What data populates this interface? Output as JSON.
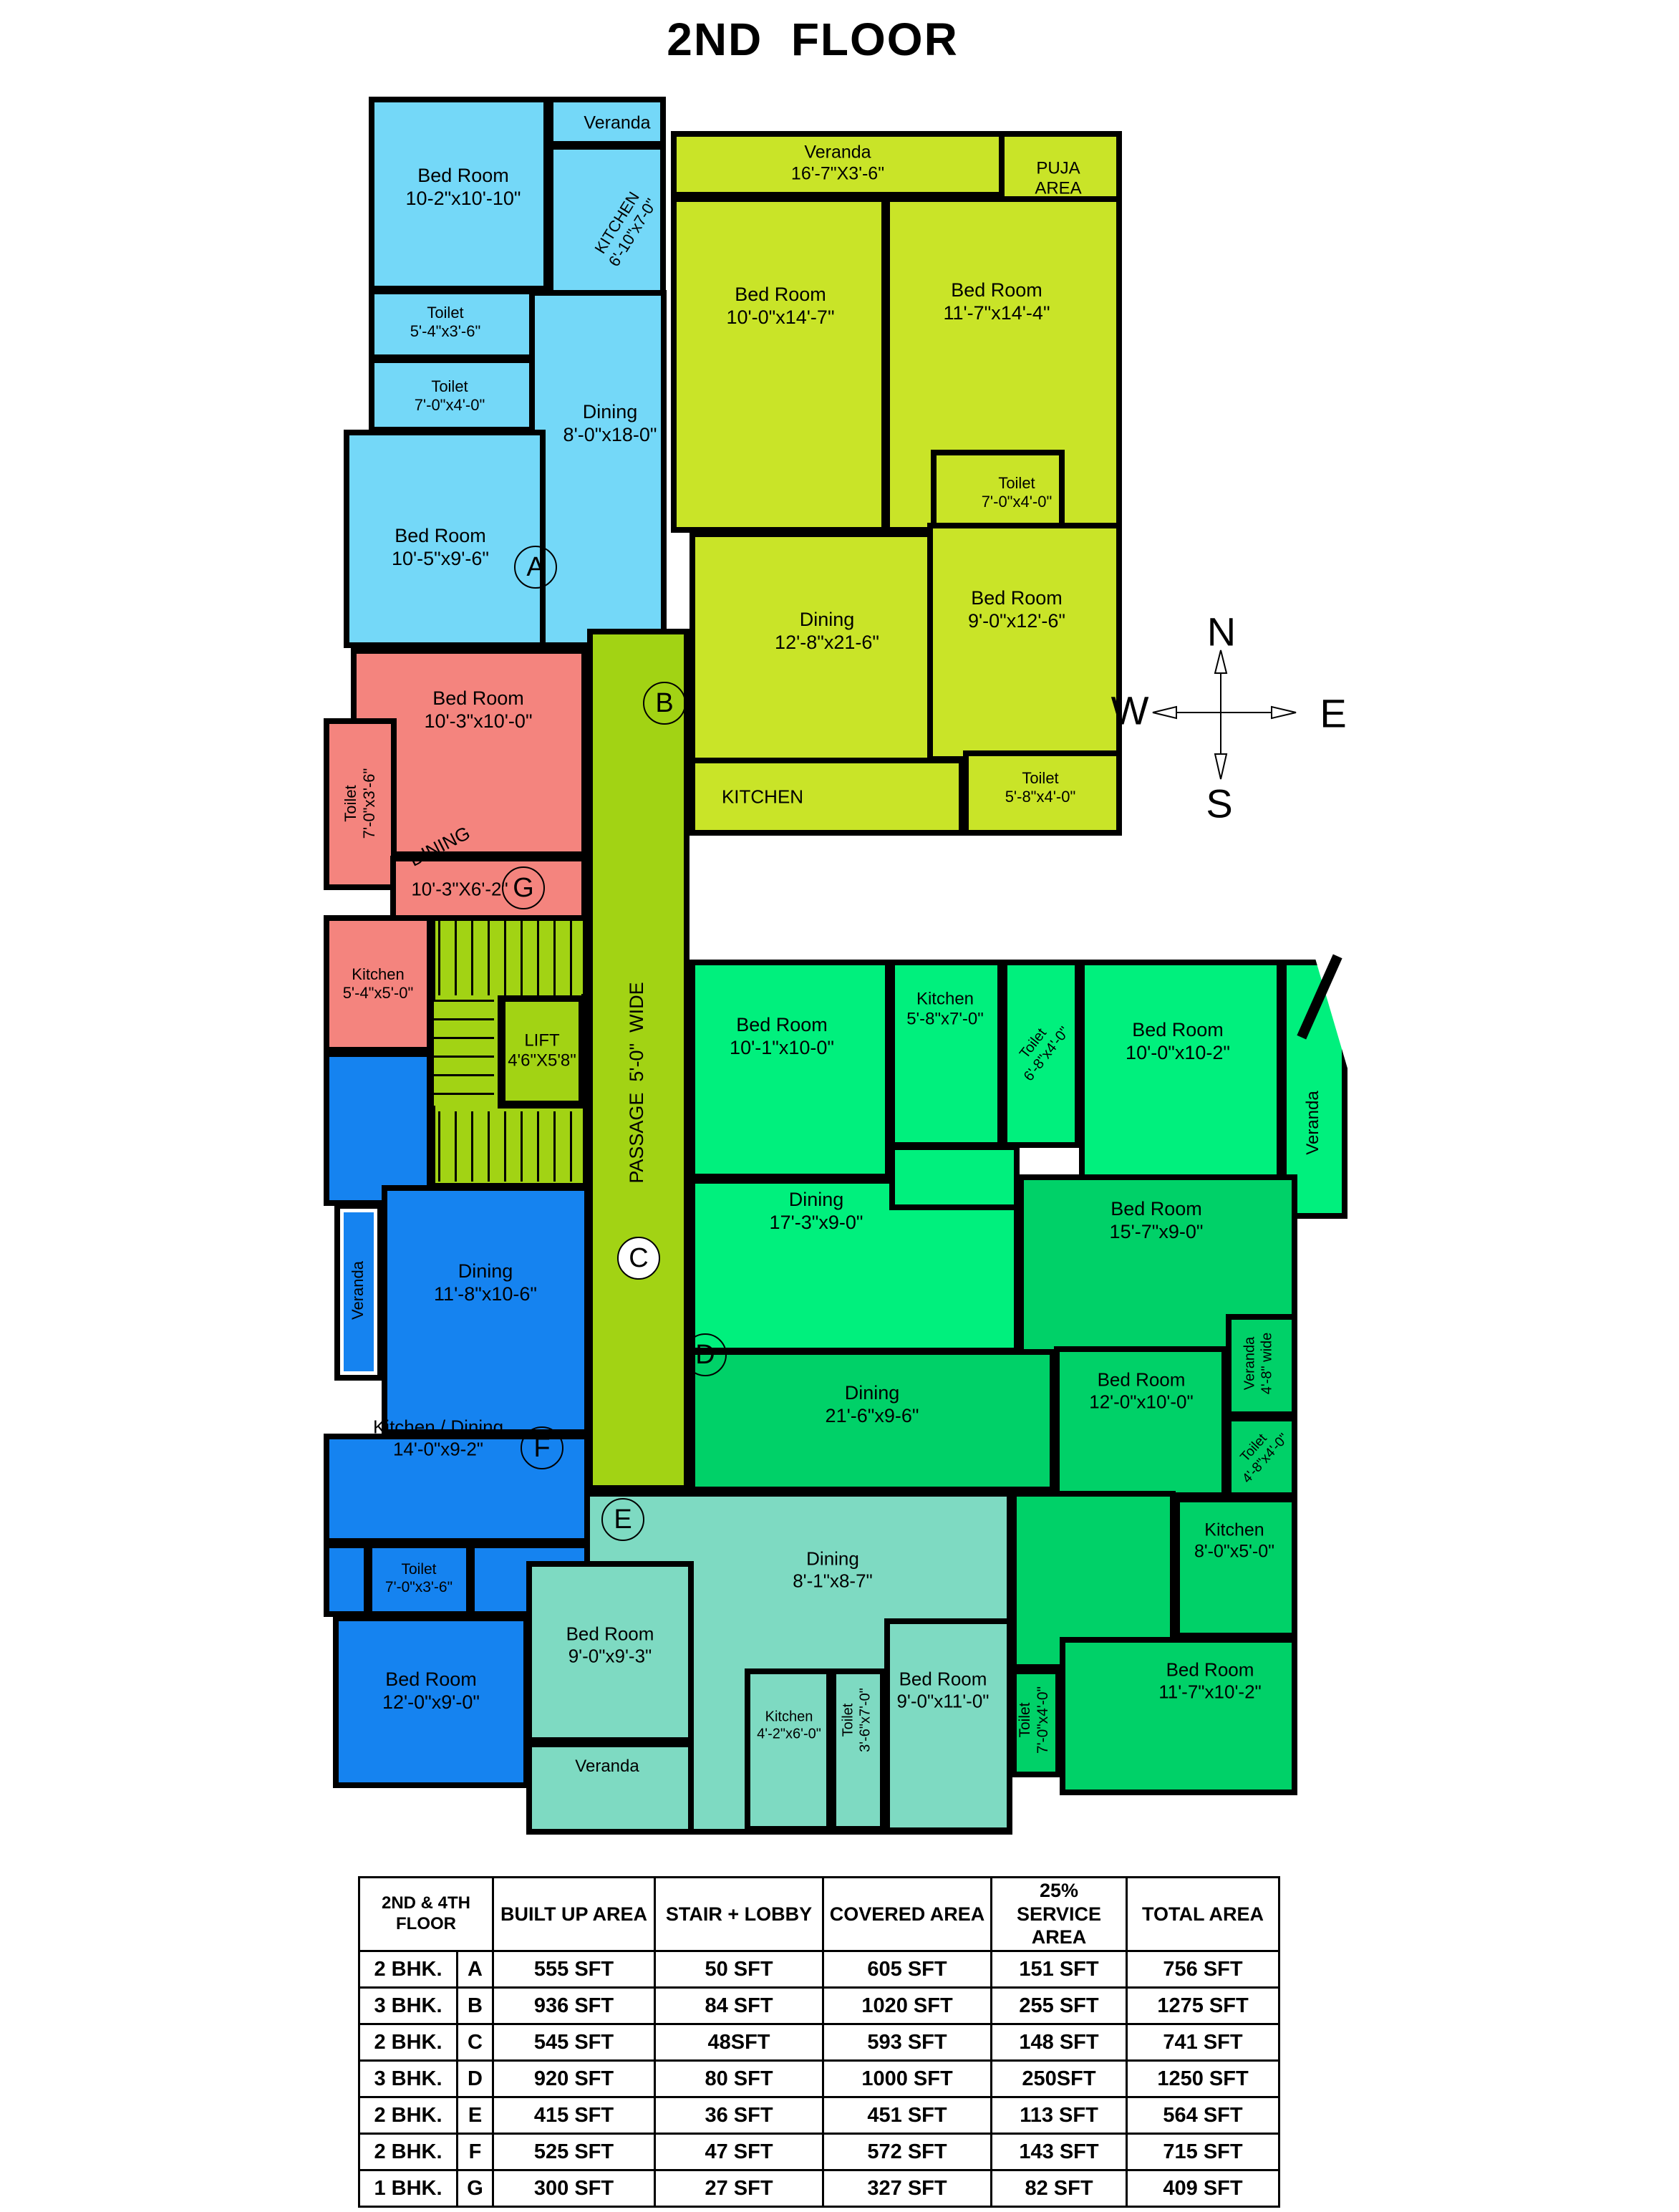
{
  "title": "2ND  FLOOR",
  "compass": {
    "north": "N",
    "south": "S",
    "east": "E",
    "west": "W"
  },
  "colors": {
    "unit_a": "#74D8F8",
    "unit_b": "#C9E428",
    "unit_c": "#00F07D",
    "unit_d": "#00D168",
    "unit_e": "#7EDAC2",
    "unit_f": "#1583F0",
    "unit_g": "#F4847E",
    "passage": "#A2D314",
    "wall": "#000000"
  },
  "plan": {
    "labels": [
      {
        "id": "a-bed1",
        "lines": [
          "Bed Room",
          "10-2\"x10'-10\""
        ]
      },
      {
        "id": "a-veranda",
        "lines": [
          "Veranda"
        ]
      },
      {
        "id": "a-kitchen",
        "lines": [
          "KITCHEN",
          "6'-10\"x7-0\""
        ]
      },
      {
        "id": "a-toilet1",
        "lines": [
          "Toilet",
          "5'-4\"x3'-6\""
        ]
      },
      {
        "id": "a-toilet2",
        "lines": [
          "Toilet",
          "7'-0\"x4'-0\""
        ]
      },
      {
        "id": "a-dining",
        "lines": [
          "Dining",
          "8'-0\"x18-0\""
        ]
      },
      {
        "id": "a-bed2",
        "lines": [
          "Bed Room",
          "10'-5\"x9'-6\""
        ]
      },
      {
        "id": "b-veranda",
        "lines": [
          "Veranda",
          "16'-7\"X3'-6\""
        ]
      },
      {
        "id": "b-puja",
        "lines": [
          "PUJA",
          "AREA"
        ]
      },
      {
        "id": "b-bed1",
        "lines": [
          "Bed Room",
          "10'-0\"x14'-7\""
        ]
      },
      {
        "id": "b-bed2",
        "lines": [
          "Bed Room",
          "11'-7\"x14'-4\""
        ]
      },
      {
        "id": "b-toilet1",
        "lines": [
          "Toilet",
          "7'-0\"x4'-0\""
        ]
      },
      {
        "id": "b-dining",
        "lines": [
          "Dining",
          "12'-8\"x21-6\""
        ]
      },
      {
        "id": "b-bed3",
        "lines": [
          "Bed Room",
          "9'-0\"x12'-6\""
        ]
      },
      {
        "id": "b-kitchen",
        "lines": [
          "KITCHEN"
        ]
      },
      {
        "id": "b-toilet2",
        "lines": [
          "Toilet",
          "5'-8\"x4'-0\""
        ]
      },
      {
        "id": "g-bed",
        "lines": [
          "Bed Room",
          "10'-3\"x10'-0\""
        ]
      },
      {
        "id": "g-toilet",
        "lines": [
          "Toilet",
          "7'-0\"x3'-6\""
        ]
      },
      {
        "id": "g-dining-word",
        "lines": [
          "DINING"
        ]
      },
      {
        "id": "g-dining-dims",
        "lines": [
          "10'-3\"X6'-2\""
        ]
      },
      {
        "id": "g-kitchen",
        "lines": [
          "Kitchen",
          "5'-4\"x5'-0\""
        ]
      },
      {
        "id": "passage",
        "lines": [
          "PASSAGE  5'-0\"  WIDE"
        ]
      },
      {
        "id": "lift",
        "lines": [
          "LIFT",
          "4'6\"X5'8\""
        ]
      },
      {
        "id": "c-bed1",
        "lines": [
          "Bed Room",
          "10'-1\"x10-0\""
        ]
      },
      {
        "id": "c-kitchen",
        "lines": [
          "Kitchen",
          "5'-8\"x7'-0\""
        ]
      },
      {
        "id": "c-toilet",
        "lines": [
          "Toilet",
          "6'-8\"x4'-0\""
        ]
      },
      {
        "id": "c-bed2",
        "lines": [
          "Bed Room",
          "10'-0\"x10-2\""
        ]
      },
      {
        "id": "c-veranda",
        "lines": [
          "Veranda"
        ]
      },
      {
        "id": "c-dining",
        "lines": [
          "Dining",
          "17'-3\"x9-0\""
        ]
      },
      {
        "id": "f-veranda",
        "lines": [
          "Veranda"
        ]
      },
      {
        "id": "f-dining",
        "lines": [
          "Dining",
          "11'-8\"x10-6\""
        ]
      },
      {
        "id": "f-kitchen",
        "lines": [
          "Kitchen / Dining",
          "14'-0\"x9-2\""
        ]
      },
      {
        "id": "f-toilet1",
        "lines": [
          "Toilet",
          "7'-0\"x3'-6\""
        ]
      },
      {
        "id": "f-bed",
        "lines": [
          "Bed Room",
          "12'-0\"x9'-0\""
        ]
      },
      {
        "id": "d-bed1",
        "lines": [
          "Bed Room",
          "15'-7\"x9-0\""
        ]
      },
      {
        "id": "d-dining",
        "lines": [
          "Dining",
          "21'-6\"x9-6\""
        ]
      },
      {
        "id": "d-bed2",
        "lines": [
          "Bed Room",
          "12'-0\"x10'-0\""
        ]
      },
      {
        "id": "d-veranda",
        "lines": [
          "Veranda",
          "4'-8\" wide"
        ]
      },
      {
        "id": "d-toilet1",
        "lines": [
          "Toilet",
          "4'-8\"x4'-0\""
        ]
      },
      {
        "id": "d-kitchen",
        "lines": [
          "Kitchen",
          "8'-0\"x5'-0\""
        ]
      },
      {
        "id": "d-bed3",
        "lines": [
          "Bed Room",
          "11'-7\"x10'-2\""
        ]
      },
      {
        "id": "d-toilet2",
        "lines": [
          "Toilet",
          "7'-0\"x4'-0\""
        ]
      },
      {
        "id": "e-dining",
        "lines": [
          "Dining",
          "8'-1\"x8-7\""
        ]
      },
      {
        "id": "e-bed1",
        "lines": [
          "Bed Room",
          "9'-0\"x9'-3\""
        ]
      },
      {
        "id": "e-veranda",
        "lines": [
          "Veranda"
        ]
      },
      {
        "id": "e-kitchen",
        "lines": [
          "Kitchen",
          "4'-2\"x6'-0\""
        ]
      },
      {
        "id": "e-toilet",
        "lines": [
          "Toilet",
          "3'-6\"x7'-0\""
        ]
      },
      {
        "id": "e-bed2",
        "lines": [
          "Bed Room",
          "9'-0\"x11'-0\""
        ]
      }
    ],
    "unit_markers": [
      {
        "letter": "A"
      },
      {
        "letter": "B"
      },
      {
        "letter": "C"
      },
      {
        "letter": "D"
      },
      {
        "letter": "E"
      },
      {
        "letter": "F"
      },
      {
        "letter": "G"
      }
    ]
  },
  "table": {
    "col_headers": [
      "2ND & 4TH FLOOR",
      "BUILT UP AREA",
      "STAIR + LOBBY",
      "COVERED AREA",
      "25% SERVICE AREA",
      "TOTAL AREA"
    ],
    "rows": [
      {
        "type": "2 BHK.",
        "flat": "A",
        "built_up": "555 SFT",
        "stair_lobby": "50 SFT",
        "covered": "605 SFT",
        "service": "151 SFT",
        "total": "756 SFT"
      },
      {
        "type": "3 BHK.",
        "flat": "B",
        "built_up": "936 SFT",
        "stair_lobby": "84 SFT",
        "covered": "1020 SFT",
        "service": "255 SFT",
        "total": "1275 SFT"
      },
      {
        "type": "2 BHK.",
        "flat": "C",
        "built_up": "545 SFT",
        "stair_lobby": "48SFT",
        "covered": "593 SFT",
        "service": "148 SFT",
        "total": "741 SFT"
      },
      {
        "type": "3 BHK.",
        "flat": "D",
        "built_up": "920 SFT",
        "stair_lobby": "80 SFT",
        "covered": "1000 SFT",
        "service": "250SFT",
        "total": "1250  SFT"
      },
      {
        "type": "2 BHK.",
        "flat": "E",
        "built_up": "415 SFT",
        "stair_lobby": "36 SFT",
        "covered": "451 SFT",
        "service": "113 SFT",
        "total": "564 SFT"
      },
      {
        "type": "2 BHK.",
        "flat": "F",
        "built_up": "525 SFT",
        "stair_lobby": "47 SFT",
        "covered": "572 SFT",
        "service": "143 SFT",
        "total": "715  SFT"
      },
      {
        "type": "1 BHK.",
        "flat": "G",
        "built_up": "300 SFT",
        "stair_lobby": "27 SFT",
        "covered": "327 SFT",
        "service": "82 SFT",
        "total": "409  SFT"
      }
    ]
  }
}
